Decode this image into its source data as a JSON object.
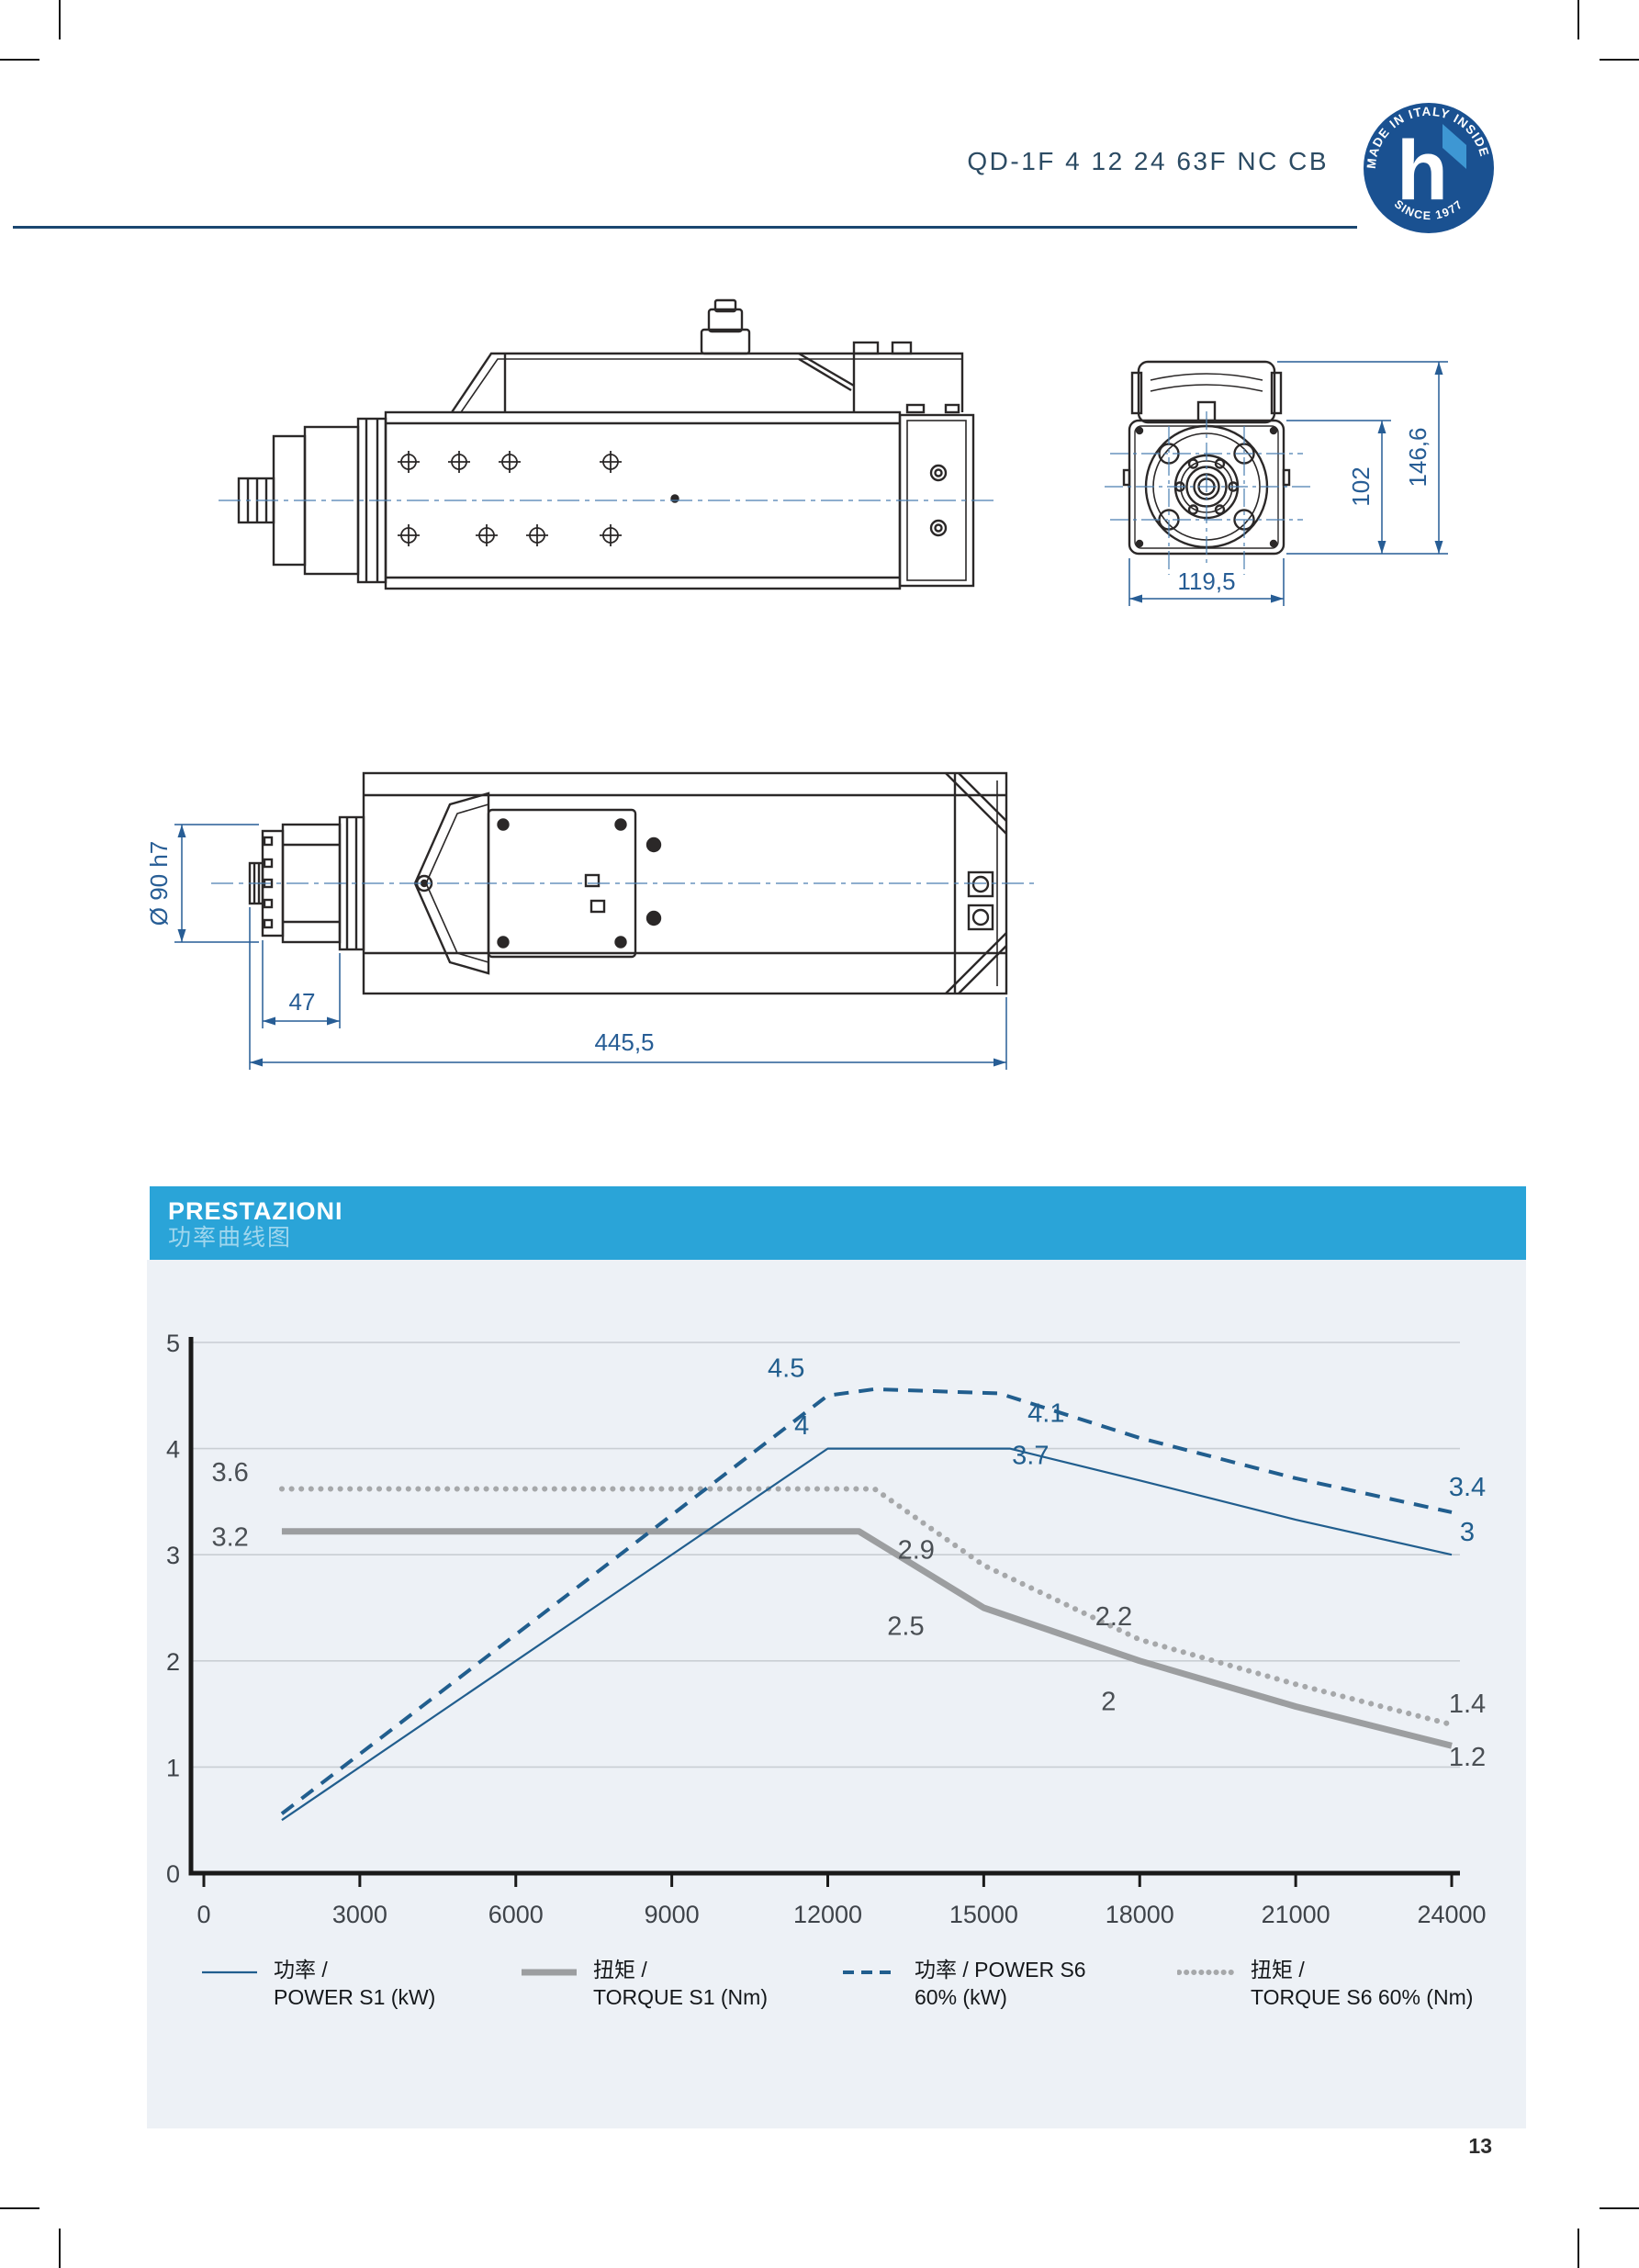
{
  "page": {
    "number": "13",
    "background": "#ffffff"
  },
  "header": {
    "title": "QD-1F 4 12 24 63F NC CB",
    "title_color": "#2c4b63",
    "rule_color": "#1b4770"
  },
  "logo": {
    "arc_top": "MADE IN ITALY INSIDE",
    "arc_bottom": "SINCE 1977",
    "letter": "h",
    "bg_color": "#1a5191",
    "flag_color": "#3e97d3"
  },
  "drawings": {
    "line_color": "#2b2828",
    "centerline_color": "#4a7eb0",
    "dim_color": "#275d95",
    "front_view": {
      "dim_total_height": "146,6",
      "dim_flange_height": "102",
      "dim_width": "119,5"
    },
    "top_view": {
      "dim_shaft_diameter": "Ø 90 h7",
      "dim_nose_length": "47",
      "dim_total_length": "445,5"
    }
  },
  "performance": {
    "title": "PRESTAZIONI",
    "subtitle": "功率曲线图",
    "header_bg": "#2aa4d8",
    "panel_bg": "#edf1f6"
  },
  "chart_data": {
    "type": "line",
    "title": "PRESTAZIONI 功率曲线图",
    "xlabel": "rpm",
    "ylabel": "",
    "xlim": [
      0,
      24000
    ],
    "ylim": [
      0,
      5
    ],
    "x_ticks": [
      0,
      3000,
      6000,
      9000,
      12000,
      15000,
      18000,
      21000,
      24000
    ],
    "y_ticks": [
      0,
      1,
      2,
      3,
      4,
      5
    ],
    "grid_on": true,
    "grid_color": "#c9ced3",
    "axis_color": "#1a1a1a",
    "legend_position": "bottom",
    "series": [
      {
        "name": "POWER S1 (kW)",
        "style": "solid_thin",
        "color": "#215e8e",
        "points": [
          [
            1500,
            0.5
          ],
          [
            12000,
            4.0
          ],
          [
            15500,
            4.0
          ],
          [
            18000,
            3.7
          ],
          [
            21000,
            3.33
          ],
          [
            24000,
            3.0
          ]
        ]
      },
      {
        "name": "TORQUE S1 (Nm)",
        "style": "solid_thick",
        "color": "#9c9ea0",
        "points": [
          [
            1500,
            3.22
          ],
          [
            12600,
            3.22
          ],
          [
            15000,
            2.5
          ],
          [
            18000,
            2.0
          ],
          [
            21000,
            1.57
          ],
          [
            24000,
            1.2
          ]
        ]
      },
      {
        "name": "POWER S6 60% (kW)",
        "style": "dashed",
        "color": "#215e8e",
        "points": [
          [
            1500,
            0.56
          ],
          [
            12000,
            4.5
          ],
          [
            12900,
            4.56
          ],
          [
            15300,
            4.52
          ],
          [
            18000,
            4.1
          ],
          [
            21000,
            3.72
          ],
          [
            24000,
            3.4
          ]
        ]
      },
      {
        "name": "TORQUE S6 60% (Nm)",
        "style": "dotted",
        "color": "#a6a8aa",
        "points": [
          [
            1500,
            3.62
          ],
          [
            12900,
            3.62
          ],
          [
            15000,
            2.9
          ],
          [
            18000,
            2.2
          ],
          [
            21000,
            1.78
          ],
          [
            24000,
            1.4
          ]
        ]
      }
    ],
    "point_labels": [
      {
        "text": "4.5",
        "rpm": 11200,
        "value": 4.76,
        "color": "#215e8e"
      },
      {
        "text": "4",
        "rpm": 11500,
        "value": 4.22,
        "color": "#215e8e"
      },
      {
        "text": "4.1",
        "rpm": 16200,
        "value": 4.34,
        "color": "#215e8e"
      },
      {
        "text": "3.7",
        "rpm": 15900,
        "value": 3.94,
        "color": "#215e8e"
      },
      {
        "text": "3.4",
        "rpm": 24300,
        "value": 3.64,
        "color": "#215e8e"
      },
      {
        "text": "3",
        "rpm": 24300,
        "value": 3.22,
        "color": "#215e8e"
      },
      {
        "text": "3.6",
        "rpm": 150,
        "value": 3.78,
        "color": "#4a4f54",
        "anchor": "start"
      },
      {
        "text": "3.2",
        "rpm": 150,
        "value": 3.17,
        "color": "#4a4f54",
        "anchor": "start"
      },
      {
        "text": "2.9",
        "rpm": 13700,
        "value": 3.05,
        "color": "#4a4f54"
      },
      {
        "text": "2.5",
        "rpm": 13500,
        "value": 2.33,
        "color": "#4a4f54"
      },
      {
        "text": "2.2",
        "rpm": 17500,
        "value": 2.42,
        "color": "#4a4f54"
      },
      {
        "text": "2",
        "rpm": 17400,
        "value": 1.62,
        "color": "#4a4f54"
      },
      {
        "text": "1.4",
        "rpm": 24300,
        "value": 1.6,
        "color": "#4a4f54"
      },
      {
        "text": "1.2",
        "rpm": 24300,
        "value": 1.1,
        "color": "#4a4f54"
      }
    ]
  },
  "legend": [
    {
      "style": "solid_thin",
      "line1": "功率 /",
      "line2": "POWER S1 (kW)"
    },
    {
      "style": "solid_thick",
      "line1": "扭矩 /",
      "line2": "TORQUE S1 (Nm)"
    },
    {
      "style": "dashed",
      "line1": "功率 / POWER S6",
      "line2": "60% (kW)"
    },
    {
      "style": "dotted",
      "line1": "扭矩 /",
      "line2": "TORQUE S6 60% (Nm)"
    }
  ]
}
